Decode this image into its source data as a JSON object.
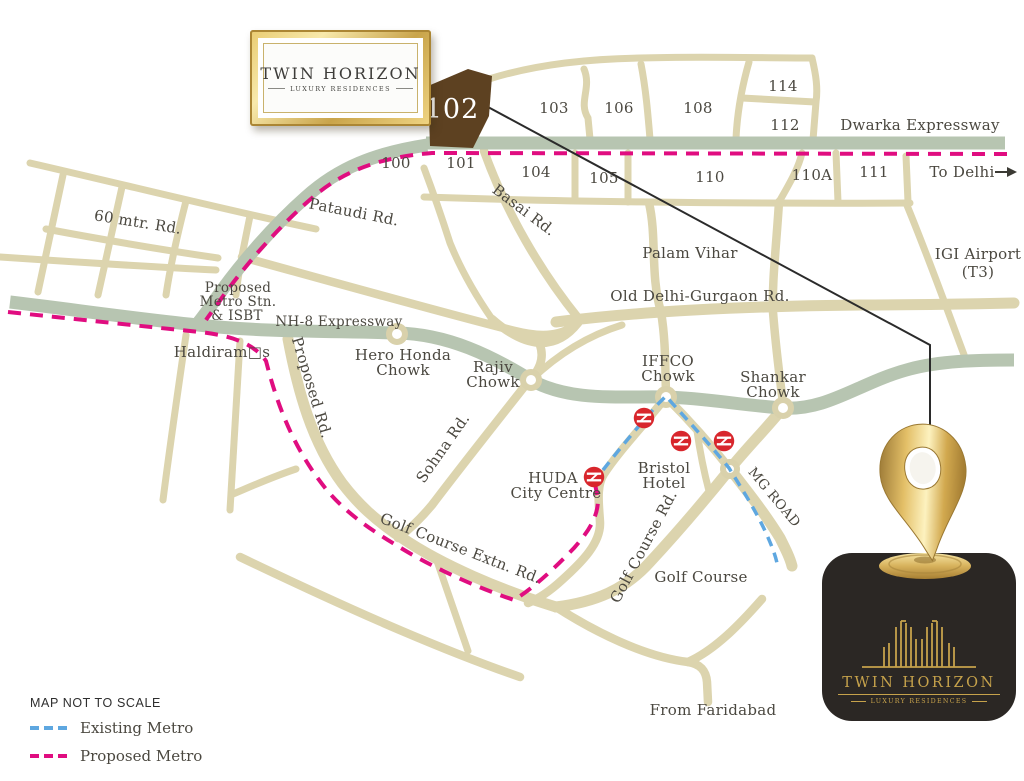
{
  "brand": {
    "name": "TWIN HORIZON",
    "tagline": "LUXURY RESIDENCES"
  },
  "plot": {
    "sector_number": "102"
  },
  "sectors": {
    "s100": "100",
    "s101": "101",
    "s103": "103",
    "s104": "104",
    "s105": "105",
    "s106": "106",
    "s108": "108",
    "s110": "110",
    "s110a": "110A",
    "s111": "111",
    "s112": "112",
    "s114": "114"
  },
  "roads": {
    "dwarka": "Dwarka Expressway",
    "to_delhi": "To Delhi",
    "pataudi": "Pataudi Rd.",
    "basai": "Basai Rd.",
    "sixty_mtr": "60 mtr. Rd.",
    "nh8": "NH-8 Expressway",
    "old_delhi_gurgaon": "Old Delhi-Gurgaon Rd.",
    "proposed_rd": "Proposed Rd.",
    "sohna": "Sohna Rd.",
    "mg_road": "MG ROAD",
    "golf_course_extn": "Golf Course Extn. Rd.",
    "golf_course_rd": "Golf Course Rd."
  },
  "places": {
    "palam_vihar": "Palam Vihar",
    "igi_line1": "IGI Airport",
    "igi_line2": "(T3)",
    "metro_stn_line1": "Proposed",
    "metro_stn_line2": "Metro Stn.",
    "metro_stn_line3": "& ISBT",
    "haldirams": "Haldiram□s",
    "hero_honda_line1": "Hero Honda",
    "hero_honda_line2": "Chowk",
    "rajiv_line1": "Rajiv",
    "rajiv_line2": "Chowk",
    "iffco_line1": "IFFCO",
    "iffco_line2": "Chowk",
    "shankar_line1": "Shankar",
    "shankar_line2": "Chowk",
    "huda_line1": "HUDA",
    "huda_line2": "City Centre",
    "bristol_line1": "Bristol",
    "bristol_line2": "Hotel",
    "golf_course": "Golf Course",
    "from_faridabad": "From Faridabad"
  },
  "legend": {
    "title": "MAP NOT TO SCALE",
    "existing_metro": "Existing Metro",
    "proposed_metro": "Proposed Metro"
  },
  "colors": {
    "road_beige": "#dcd4ae",
    "expressway_green": "#b7c5b1",
    "proposed_metro_pink": "#e00d80",
    "existing_metro_blue": "#5ea7e0",
    "plot_brown": "#5d4121",
    "label_text": "#4b4840",
    "metro_icon_red": "#d8262c",
    "brand_gold": "#c6a24b",
    "card_background": "#2b2724"
  }
}
